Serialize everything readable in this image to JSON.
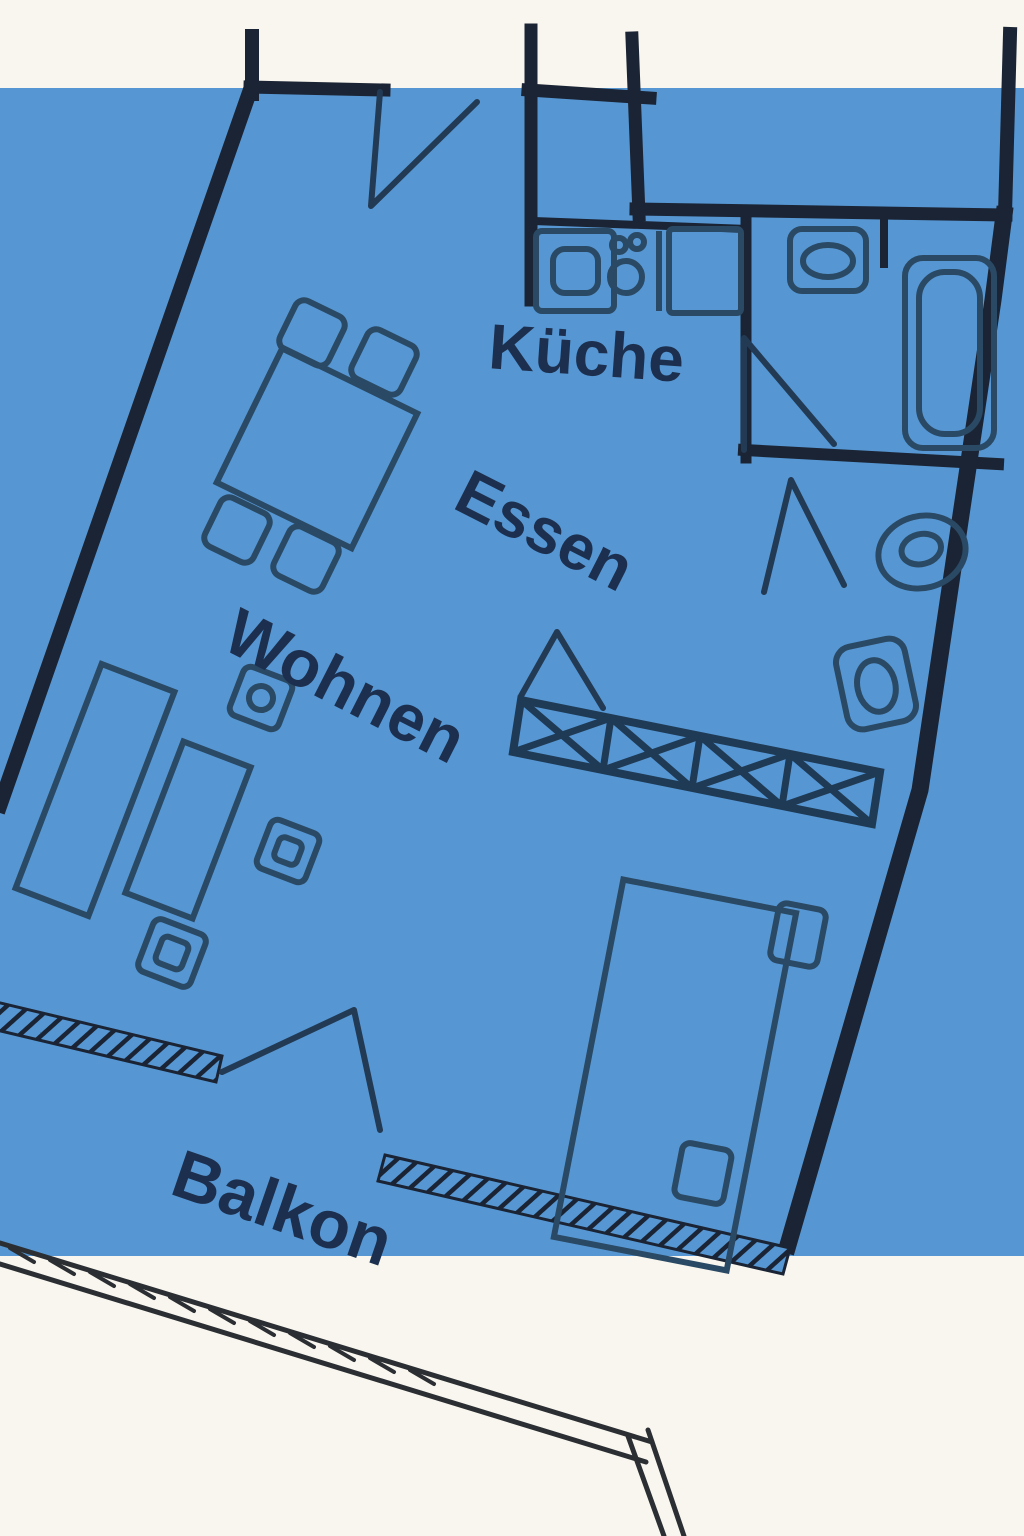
{
  "title": "apartment-floor-plan",
  "colors": {
    "background_blue": "#5697d3",
    "paper_white": "#f8f6ee",
    "wall": "#1b2434",
    "furniture_line": "#2a4964",
    "label_text": "#1c2f4e"
  },
  "rooms": [
    {
      "id": "kueche",
      "label": "Küche"
    },
    {
      "id": "essen",
      "label": "Essen"
    },
    {
      "id": "wohnen",
      "label": "Wohnen"
    },
    {
      "id": "balkon",
      "label": "Balkon"
    }
  ],
  "fixtures": {
    "kitchen": [
      "stove-icon",
      "sink-icon",
      "counter"
    ],
    "bathroom": [
      "toilet-icon",
      "bathtub-icon",
      "door-swing"
    ],
    "wc": [
      "washbasin-icon",
      "toilet-icon",
      "door-swing"
    ],
    "hall": [
      "wardrobe-x-band",
      "bedroom-door-swing"
    ],
    "dining": [
      "table",
      "chair",
      "chair",
      "chair",
      "chair"
    ],
    "living": [
      "sofa",
      "sofa",
      "side-table",
      "side-table",
      "side-table"
    ],
    "bedroom": [
      "bed",
      "nightstand",
      "nightstand"
    ],
    "balcony": [
      "railing",
      "balcony-door-swing"
    ],
    "entry": [
      "entry-door-swing"
    ]
  }
}
